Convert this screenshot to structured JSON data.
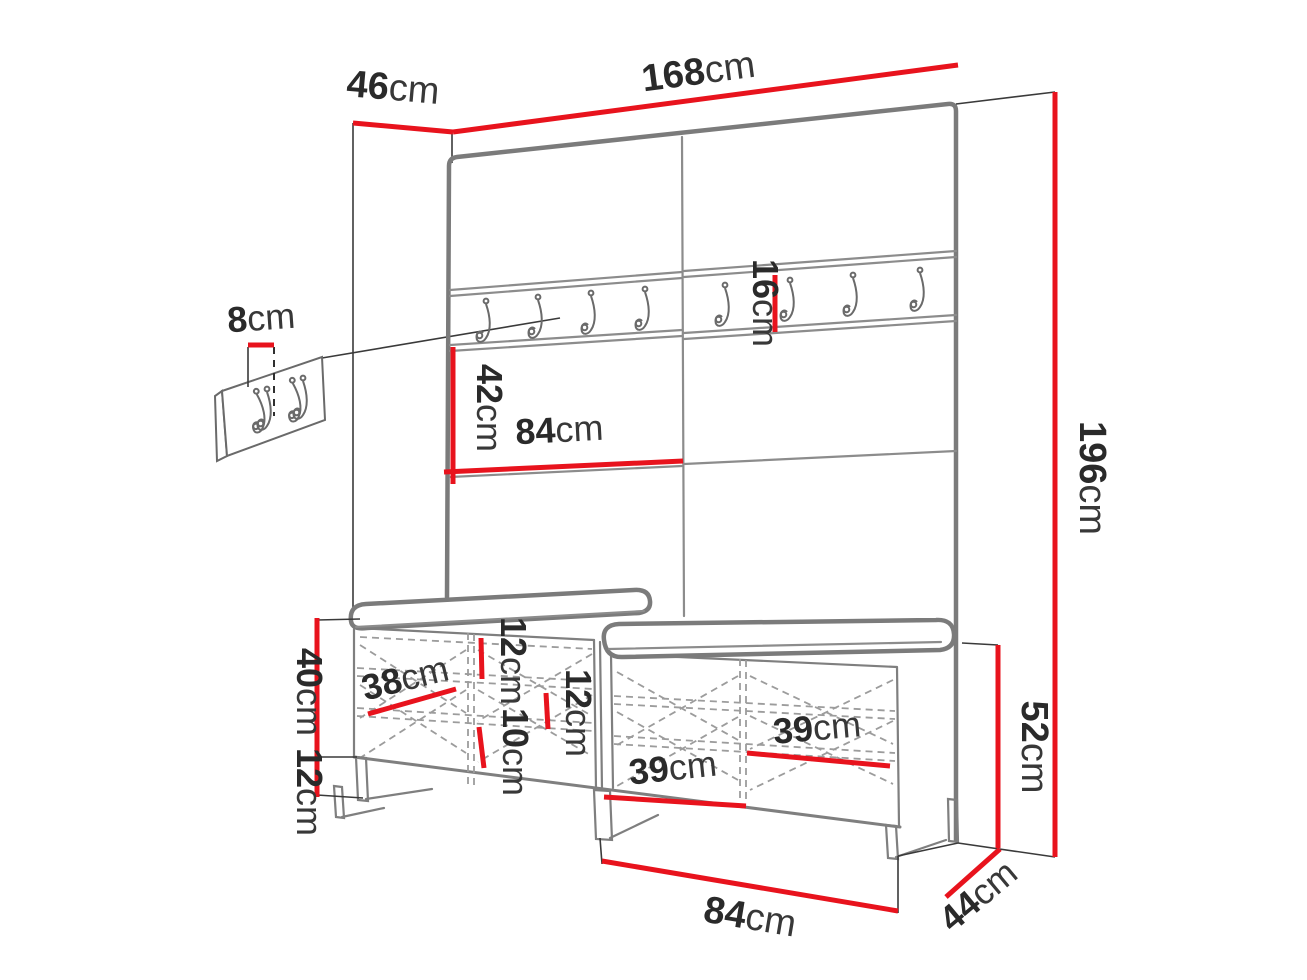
{
  "title": "Hallway furniture set dimension diagram (wall panel with coat hooks and shoe bench)",
  "colors": {
    "dimension_red": "#e8131d",
    "outline_gray": "#7b7b7b",
    "text_dark": "#2a2a2a",
    "background": "#ffffff"
  },
  "parts": {
    "rail_hook_count": 8,
    "plaque_hook_count": 2,
    "bench_cushion_count": 2
  },
  "dimensions": {
    "width_total": {
      "num": "168",
      "unit": "cm"
    },
    "depth_top": {
      "num": "46",
      "unit": "cm"
    },
    "height_total": {
      "num": "196",
      "unit": "cm"
    },
    "plaque_width": {
      "num": "8",
      "unit": "cm"
    },
    "rail_height": {
      "num": "16",
      "unit": "cm"
    },
    "panel_section_h": {
      "num": "42",
      "unit": "cm"
    },
    "panel_section_w": {
      "num": "84",
      "unit": "cm"
    },
    "bench_body_h": {
      "num": "40",
      "unit": "cm"
    },
    "leg_h": {
      "num": "12",
      "unit": "cm"
    },
    "compartment_depth": {
      "num": "38",
      "unit": "cm"
    },
    "shelf_gap_top": {
      "num": "12",
      "unit": "cm"
    },
    "shelf_gap_bottom": {
      "num": "10",
      "unit": "cm"
    },
    "shelf_gap_mid": {
      "num": "12",
      "unit": "cm"
    },
    "compartment_w_left": {
      "num": "39",
      "unit": "cm"
    },
    "compartment_w_right": {
      "num": "39",
      "unit": "cm"
    },
    "bench_total_h": {
      "num": "52",
      "unit": "cm"
    },
    "bench_width": {
      "num": "84",
      "unit": "cm"
    },
    "bench_depth": {
      "num": "44",
      "unit": "cm"
    }
  }
}
